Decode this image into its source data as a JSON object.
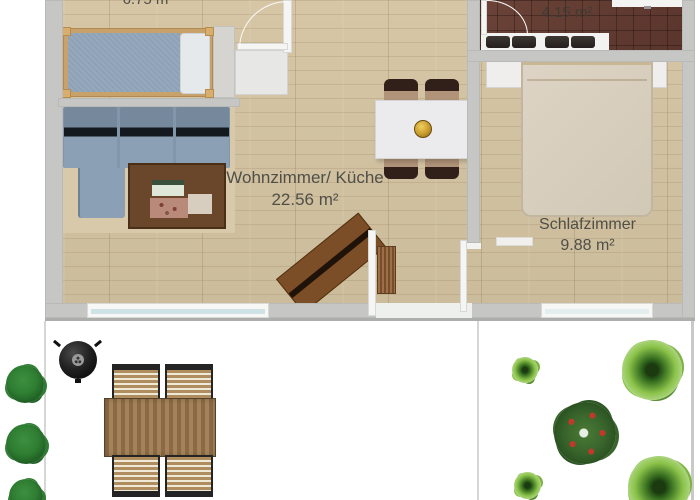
{
  "rooms": {
    "child_room": {
      "area": "6.75 m²"
    },
    "living_kitchen": {
      "name": "Wohnzimmer/ Küche",
      "area": "22.56 m²"
    },
    "shower_bath": {
      "name": "Duschbad",
      "area": "4.15 m²"
    },
    "bedroom": {
      "name": "Schlafzimmer",
      "area": "9.88 m²"
    }
  },
  "colors": {
    "wall": "#c6c6c4",
    "wood_floor": "#d0c0a0",
    "bath_tile": "#60392f",
    "sofa_blue": "#8196aa",
    "label_text": "#504f47",
    "bush_dark_green": "#2e7d32",
    "tree_bright_green": "#8bc34a",
    "apple_red": "#c0392b",
    "wood_furniture": "#8a6a45"
  },
  "objects": [
    "single-bed",
    "corner-sofa",
    "coffee-table",
    "tall-cabinet",
    "kitchen-counter",
    "dining-table",
    "dining-chair",
    "fruit-bowl",
    "sideboard",
    "doormat",
    "entrance-door",
    "room-door",
    "double-bed",
    "nightstand",
    "bathroom-vanity",
    "shower-screen",
    "kettle-grill",
    "garden-table",
    "garden-chair",
    "hedge-bush",
    "apple-tree",
    "garden-tree",
    "window"
  ]
}
